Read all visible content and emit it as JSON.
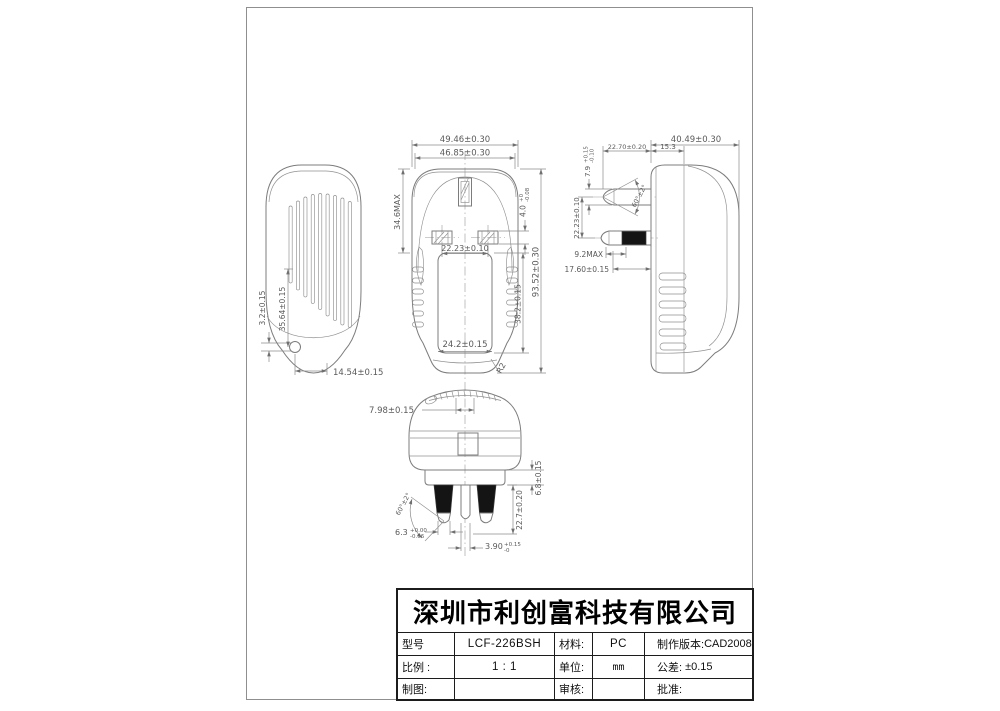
{
  "dims": {
    "front": {
      "overall_width": "49.46±0.30",
      "inner_width": "46.85±0.30",
      "top_height_max": "34.6MAX",
      "pin_thickness_base": "4.0",
      "pin_thickness_tol_up": "+0",
      "pin_thickness_tol_dn": "-0.08",
      "pin_pitch": "22.23±0.10",
      "overall_height": "93.52±0.30",
      "label_recess_height": "38.2±0.15",
      "label_recess_width": "24.2±0.15",
      "corner_radius": "R2"
    },
    "side": {
      "overall_depth": "40.49±0.30",
      "pin_length": "22.70±0.20",
      "face_depth": "15.3",
      "earth_pin_width_base": "7.9",
      "earth_pin_width_tol_up": "+0.15",
      "earth_pin_width_tol_dn": "-0.10",
      "pin_tip_angle": "60°±2°",
      "pin_vertical_pitch": "22.23±0.10",
      "pin_black_length_max": "9.2MAX",
      "pin_exposed_length": "17.60±0.15"
    },
    "back": {
      "led_offset": "3.2±0.15",
      "led_height": "35.64±0.15",
      "led_horizontal": "14.54±0.15"
    },
    "bottom": {
      "top_feature_width": "7.98±0.15",
      "base_height": "6.8±0.15",
      "pin_length": "22.7±0.20",
      "pin_angle": "60°±2°",
      "side_pin_width_base": "6.3",
      "side_pin_width_tol_up": "+0.00",
      "side_pin_width_tol_dn": "-0.06",
      "center_pin_width_base": "3.90",
      "center_pin_width_tol_up": "+0.15",
      "center_pin_width_tol_dn": "-0"
    }
  },
  "title_block": {
    "company": "深圳市利创富科技有限公司",
    "rows": [
      {
        "label_a": "型号",
        "value_a": "LCF-226BSH",
        "label_b": "材料:",
        "value_b": "PC",
        "label_c": "制作版本:",
        "value_c": "CAD2008"
      },
      {
        "label_a": "比例 :",
        "value_a": "1 : 1",
        "label_b": "单位:",
        "value_b": "mm",
        "label_c": "公差:",
        "value_c": "±0.15"
      },
      {
        "label_a": "制图:",
        "value_a": "",
        "label_b": "审核:",
        "value_b": "",
        "label_c": "批准:",
        "value_c": ""
      }
    ]
  }
}
